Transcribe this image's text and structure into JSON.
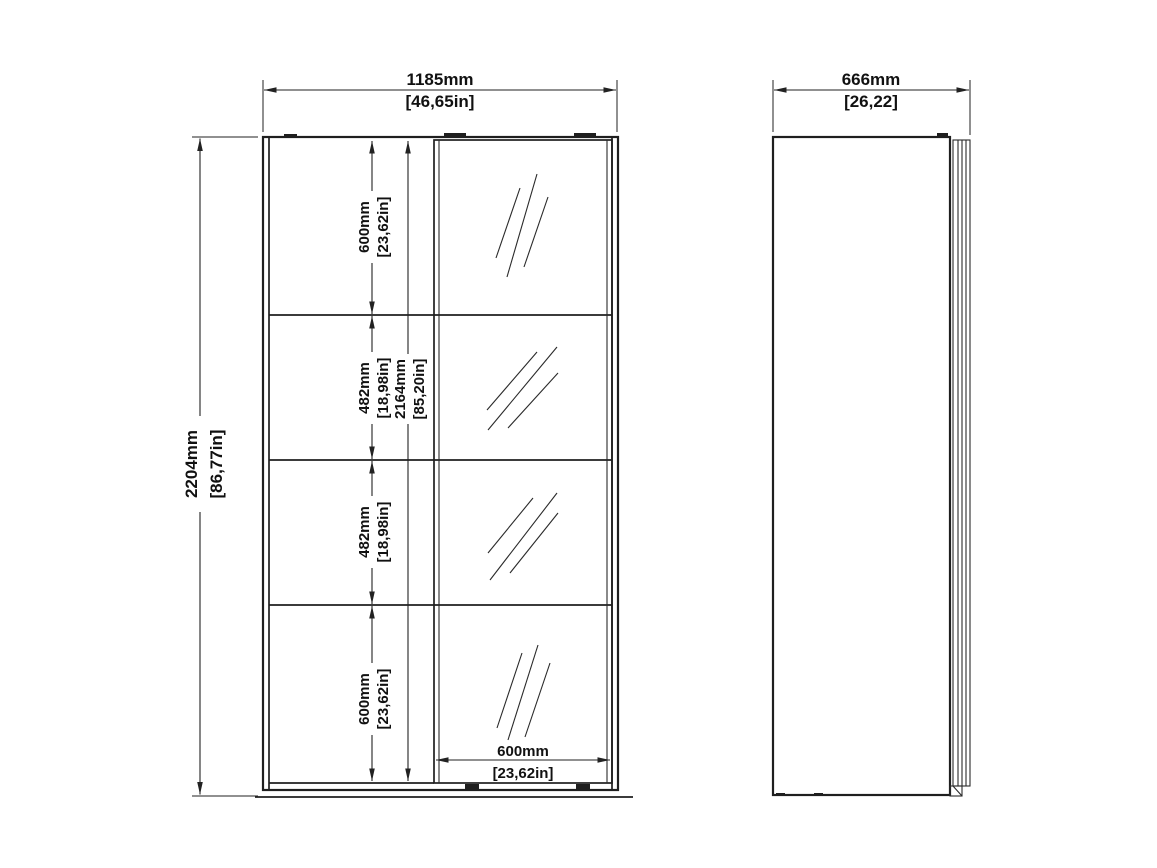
{
  "drawing": {
    "background_color": "#ffffff",
    "line_color": "#1f1f1f",
    "front_view": {
      "overall_width": {
        "mm": "1185mm",
        "in": "[46,65in]"
      },
      "overall_height": {
        "mm": "2204mm",
        "in": "[86,77in]"
      },
      "interior_height": {
        "mm": "2164mm",
        "in": "[85,20in]"
      },
      "door_width": {
        "mm": "600mm",
        "in": "[23,62in]"
      },
      "shelf_sections": [
        {
          "mm": "600mm",
          "in": "[23,62in]"
        },
        {
          "mm": "482mm",
          "in": "[18,98in]"
        },
        {
          "mm": "482mm",
          "in": "[18,98in]"
        },
        {
          "mm": "600mm",
          "in": "[23,62in]"
        }
      ]
    },
    "side_view": {
      "overall_depth": {
        "mm": "666mm",
        "in": "[26,22]"
      }
    }
  }
}
